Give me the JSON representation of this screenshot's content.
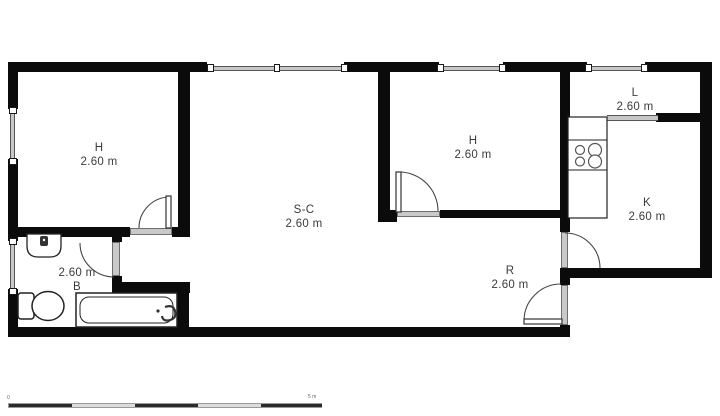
{
  "plan": {
    "rooms": [
      {
        "id": "bedroom-left",
        "label": "H",
        "size": "2.60 m"
      },
      {
        "id": "living-room",
        "label": "S-C",
        "size": "2.60 m"
      },
      {
        "id": "bedroom-right",
        "label": "H",
        "size": "2.60 m"
      },
      {
        "id": "hall",
        "label": "L",
        "size": "2.60 m"
      },
      {
        "id": "kitchen",
        "label": "K",
        "size": "2.60 m"
      },
      {
        "id": "bathroom",
        "label": "B",
        "size": "2.60 m"
      },
      {
        "id": "entry",
        "label": "R",
        "size": "2.60 m"
      }
    ],
    "scale_bar": {
      "start_label": "0",
      "end_label": "5 m"
    },
    "fixtures": [
      "bathtub",
      "toilet",
      "sink",
      "kitchen-counter",
      "stove-burners"
    ],
    "colors": {
      "wall": "#0b0b0b",
      "window": "#c7c7c7",
      "text": "#3b3b3b",
      "background": "#ffffff"
    }
  }
}
